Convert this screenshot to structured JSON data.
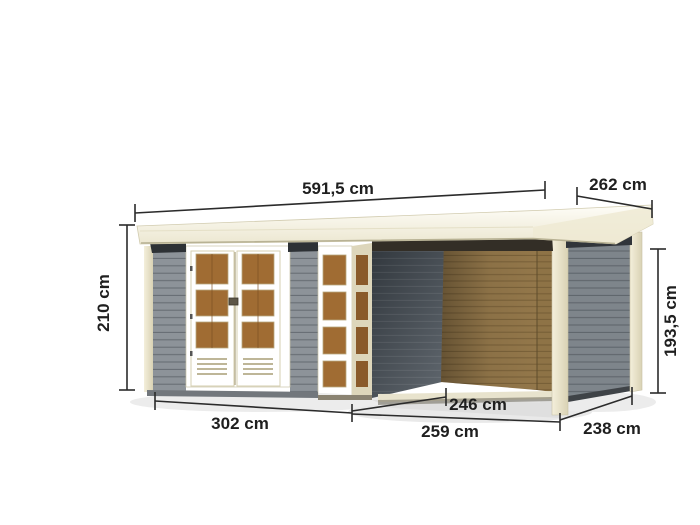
{
  "page": {
    "type": "product-dimension-diagram",
    "subject": "Flat-roof garden shed with double glazed doors, corner window element and attached side canopy",
    "unit": "cm"
  },
  "dimensions": {
    "roof_width": "591,5 cm",
    "roof_depth": "262 cm",
    "height_left": "210 cm",
    "height_right": "193,5 cm",
    "shed_front_width": "302 cm",
    "annex_inner_depth": "246 cm",
    "annex_front_width": "259 cm",
    "annex_side_depth": "238 cm"
  },
  "colors": {
    "roof_cream": "#f6f3e3",
    "trim_cream": "#f1ecd8",
    "trim_cream_shaded": "#ddd6bb",
    "wall_grey": "#8d9399",
    "wall_grey_dark": "#7e858b",
    "shadow_wall_grey": "#474e55",
    "wood_brown": "#93774a",
    "wood_brown_dark": "#8e7346",
    "pane_brown": "#a06c33",
    "pane_brown_shaded": "#8a5a2a",
    "eave_shadow": "#2d3135",
    "base_grey": "#72777c",
    "dimension_ink": "#2b2b2b"
  }
}
